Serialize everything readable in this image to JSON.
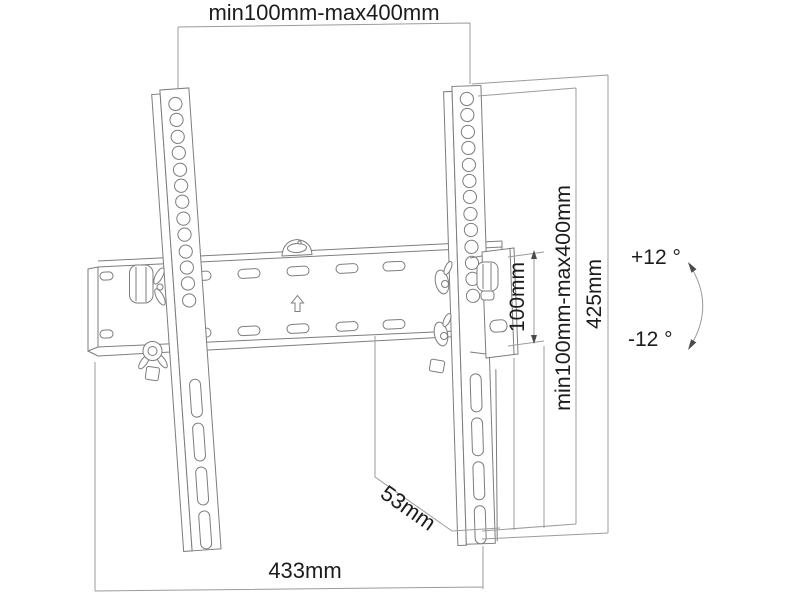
{
  "page": {
    "background": "#ffffff"
  },
  "diagram": {
    "type": "technical-dimension-drawing",
    "subject": "tilting-tv-wall-mount-bracket",
    "colors": {
      "background": "#ffffff",
      "drawing_line": "#7d7d7d",
      "dimension_line": "#9b9b9b",
      "text": "#1c1c1c"
    },
    "dimensions": {
      "top_width_range": "min100mm-max400mm",
      "bracket_plate_height": "100mm",
      "vertical_range": "min100mm-max400mm",
      "overall_height": "425mm",
      "tilt_up": "+12 °",
      "tilt_down": "-12 °",
      "wall_plate_depth": "53mm",
      "overall_width": "433mm"
    },
    "symbols": {
      "orientation_arrow": "up-arrow",
      "level_indicator": "bubble-level",
      "tilt_arc": "double-headed-arc-arrow"
    }
  }
}
